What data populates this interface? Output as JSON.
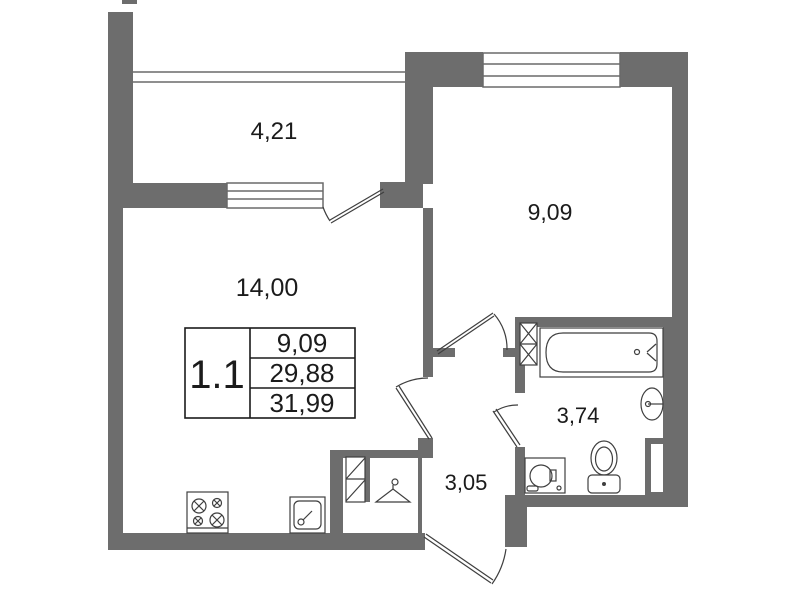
{
  "plan": {
    "title": "apartment-floor-plan",
    "unit": "1.1",
    "info_table": {
      "unit": "1.1",
      "rows": [
        "9,09",
        "29,88",
        "31,99"
      ]
    },
    "rooms": [
      {
        "name": "balcony",
        "area": "4,21"
      },
      {
        "name": "bedroom",
        "area": "9,09"
      },
      {
        "name": "living-kitchen",
        "area": "14,00"
      },
      {
        "name": "bathroom",
        "area": "3,74"
      },
      {
        "name": "hallway",
        "area": "3,05"
      }
    ],
    "fixtures": [
      "bathtub",
      "wash-basin",
      "toilet",
      "washing-machine",
      "stove",
      "kitchen-sink",
      "wardrobe-hanger",
      "vent-shaft"
    ],
    "colors": {
      "wall": "#6d6d6d",
      "outline": "#3f3f3f",
      "window_line": "#6a6a6a",
      "text": "#1b1b1b",
      "background": "#ffffff"
    }
  }
}
